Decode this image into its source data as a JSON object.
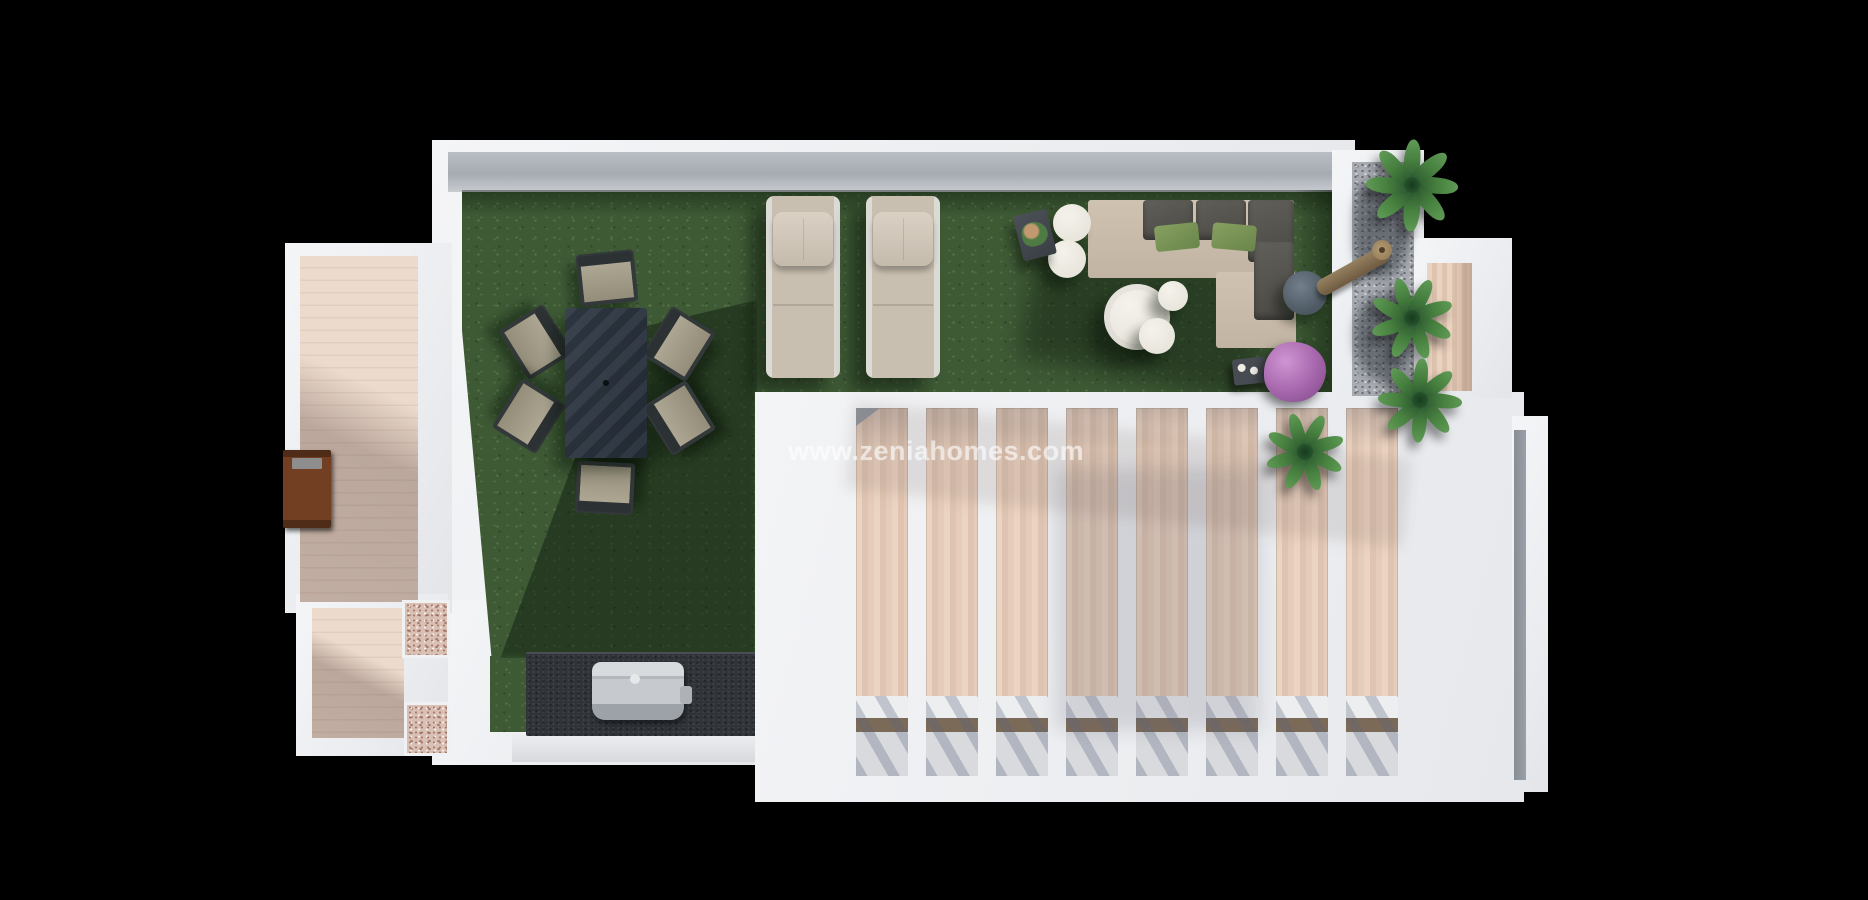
{
  "watermark": {
    "text": "www.zeniahomes.com"
  },
  "scene": {
    "title": "Top-down 3D render of a rooftop terrace floor plan",
    "areas": {
      "lawn": "artificial-grass terrace",
      "left_balcony": "wood-deck balcony",
      "bottom_left_deck": "wood-deck patio with pink gravel beds",
      "pergola": "white slatted pergola over wood deck",
      "gravel_bed": "grey pebble planter strip with palms",
      "right_terrace": "small wood-deck terrace",
      "bbq_area": "dark barbecue counter with steel grill",
      "lounge": "L-shaped outdoor sofa with round tables"
    },
    "counts": {
      "dining_chairs": 6,
      "sun_loungers": 2,
      "pergola_slats": 8,
      "palm_plants": 4,
      "white_poufs": 5
    },
    "palette": {
      "background": "#000000",
      "walls": "#eef0f2",
      "wall_cap": "#a9aeb4",
      "lawn": "#3e5a35",
      "deck_wood": "#e8d5c7",
      "pergola_wood": "#e5cbb8",
      "dining_table": "#2c3540",
      "chair_seat": "#a39d8a",
      "lounger": "#cbc1b2",
      "sofa": "#c9bcab",
      "sofa_cushion": "#56544f",
      "pillow_green": "#7b9457",
      "pouf_white": "#efece7",
      "gravel": "#a8acb2",
      "foliage": "#3f6f3f",
      "bush_purple": "#a868af",
      "planter_brown": "#6d3f24",
      "bbq_counter": "#303439",
      "grill_steel": "#c2c6ca",
      "watermark_text": "rgba(255,255,255,0.58)"
    },
    "plants": [
      {
        "x": 1412,
        "y": 185,
        "r": 46
      },
      {
        "x": 1412,
        "y": 318,
        "r": 42
      },
      {
        "x": 1420,
        "y": 400,
        "r": 42
      },
      {
        "x": 1305,
        "y": 452,
        "r": 40
      }
    ]
  }
}
